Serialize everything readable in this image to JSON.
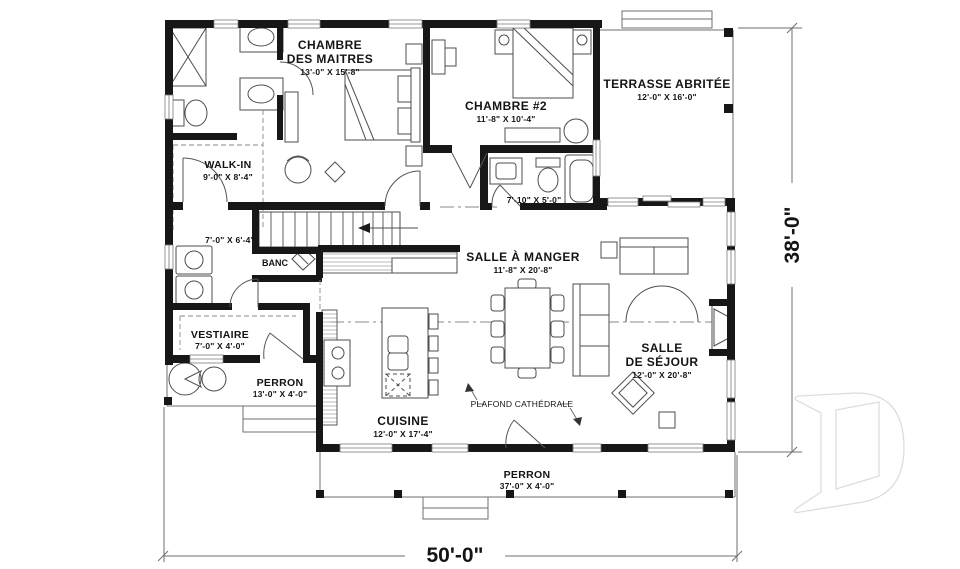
{
  "plan": {
    "rooms": {
      "master": {
        "line1": "CHAMBRE",
        "line2": "DES MAITRES",
        "dims": "13'-0\" X 15'-8\""
      },
      "chambre2": {
        "name": "CHAMBRE #2",
        "dims": "11'-8\" X 10'-4\""
      },
      "terrasse": {
        "name": "TERRASSE ABRITÉE",
        "dims": "12'-0\" X 16'-0\""
      },
      "walkin": {
        "name": "WALK-IN",
        "dims": "9'-0\" X 8'-4\""
      },
      "hall": {
        "dims": "7'-0\" X 6'-4\""
      },
      "bain": {
        "dims": "7'-10\" X 5'-0\""
      },
      "salle_a_manger": {
        "name": "SALLE À MANGER",
        "dims": "11'-8\" X 20'-8\""
      },
      "sejour": {
        "line1": "SALLE",
        "line2": "DE SÉJOUR",
        "dims": "12'-0\" X 20'-8\""
      },
      "vestiaire": {
        "name": "VESTIAIRE",
        "dims": "7'-0\" X 4'-0\""
      },
      "perron_gauche": {
        "name": "PERRON",
        "dims": "13'-0\" X 4'-0\""
      },
      "cuisine": {
        "name": "CUISINE",
        "dims": "12'-0\" X 17'-4\""
      },
      "perron_avant": {
        "name": "PERRON",
        "dims": "37'-0\" X 4'-0\""
      }
    },
    "annotations": {
      "banc": "BANC",
      "plafond": "PLAFOND CATHÉDRALE"
    },
    "dimensions": {
      "width": "50'-0\"",
      "depth": "38'-0\""
    },
    "colors": {
      "wall": "#171717",
      "furniture_line": "#4d4d4d",
      "watermark": "#dddddd"
    }
  }
}
